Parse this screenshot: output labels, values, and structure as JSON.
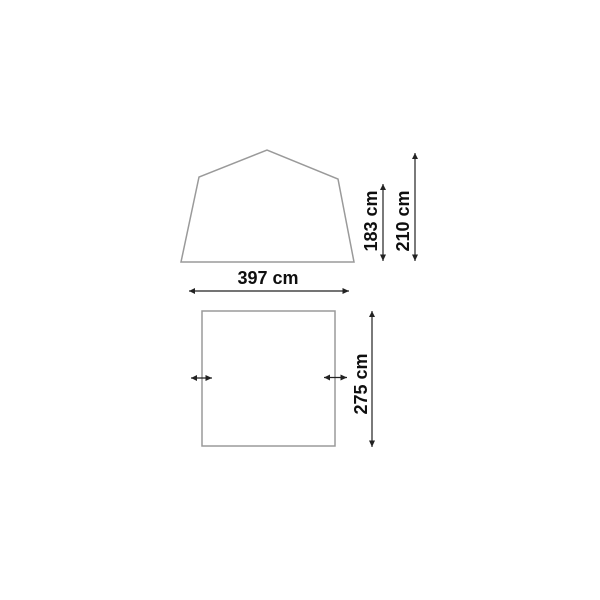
{
  "diagram": {
    "front_view": {
      "wall_height_label": "183 cm",
      "peak_height_label": "210 cm",
      "width_label": "397 cm"
    },
    "top_view": {
      "depth_label": "275 cm"
    },
    "colors": {
      "outline": "#9a9a9a",
      "dimension": "#222222",
      "label": "#0f0f0f",
      "background": "#ffffff"
    }
  }
}
